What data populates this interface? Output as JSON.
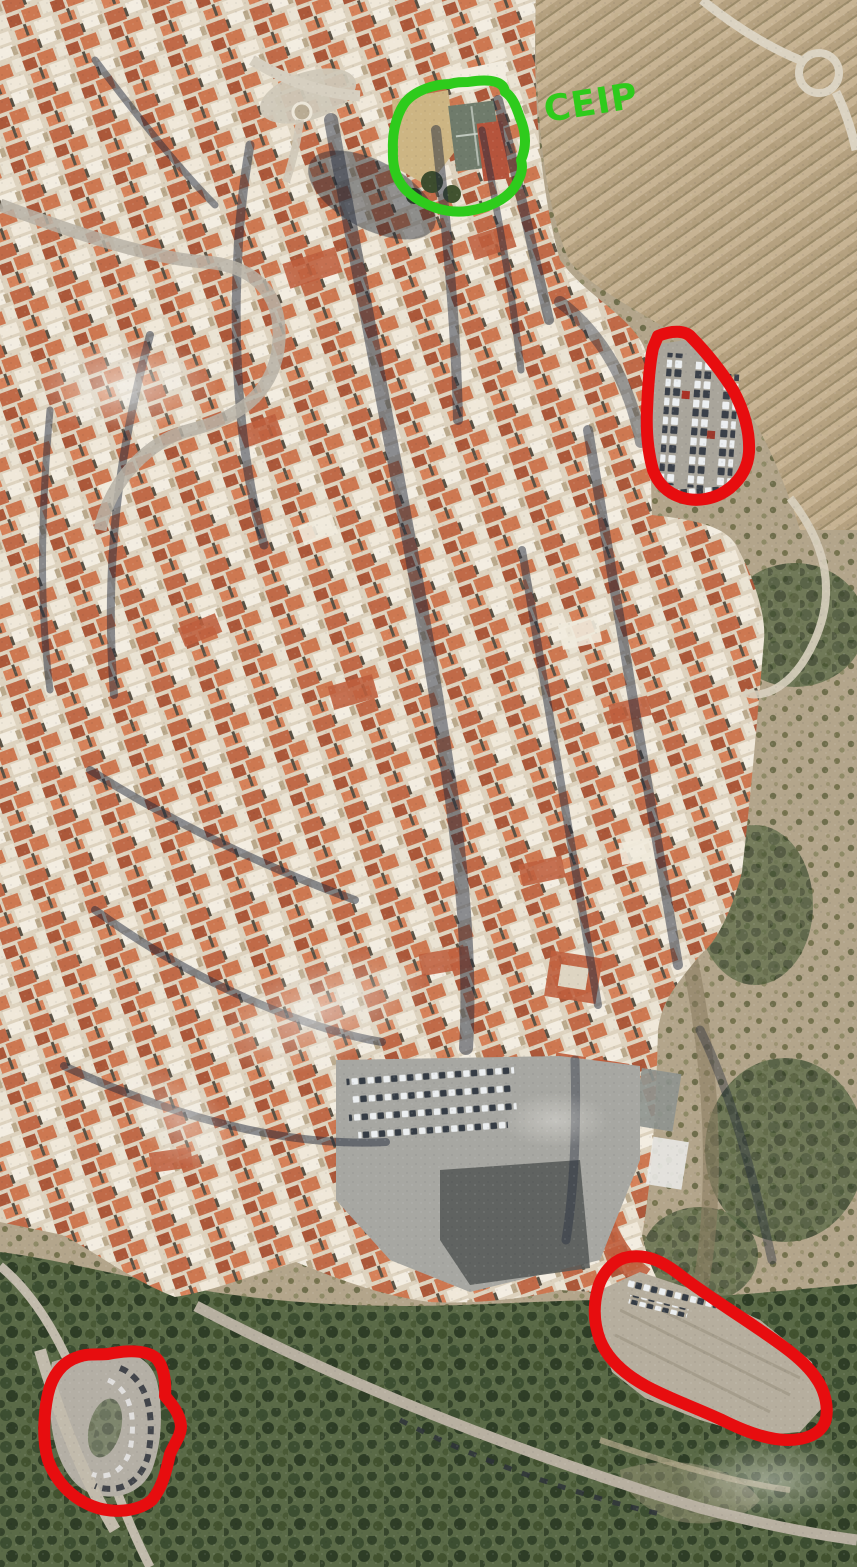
{
  "scene": {
    "type": "aerial-satellite-photo",
    "description": "Aerial view of a dense historic hilltop town with terracotta rooftops and narrow shadowed streets, bordered by terraced fields to the east and wooded slopes to the south",
    "annotated_features": [
      {
        "id": "school-grounds",
        "marker": "green-circle",
        "label": "CEIP"
      },
      {
        "id": "northeast-parking-lot",
        "marker": "red-outline"
      },
      {
        "id": "southeast-gravel-parking",
        "marker": "red-outline"
      },
      {
        "id": "southwest-parking-loop",
        "marker": "red-outline"
      }
    ]
  },
  "annotations": {
    "green": {
      "label": "CEIP",
      "color": "#2ecb1c"
    },
    "red": {
      "color": "#e70d0f"
    }
  },
  "palette": {
    "terrain_tan": "#b3a58b",
    "roof_terracotta": "#c06a48",
    "building_light": "#f0e8d9",
    "street_shadow": "#232a3c",
    "vegetation_dark": "#42522f",
    "asphalt_grey": "#a7a7a2"
  }
}
